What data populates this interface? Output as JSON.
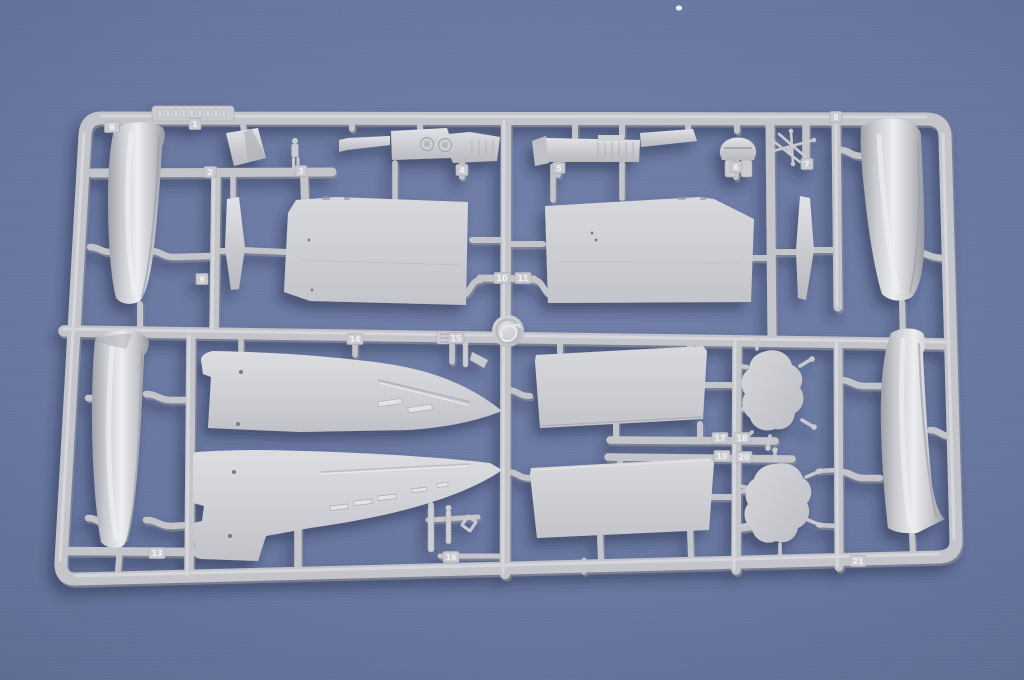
{
  "scene": {
    "subject": "Light grey injection-moulded plastic model kit sprue (runner B) with aircraft parts, photographed on a blue background",
    "background_colors": {
      "center": "#6d7ca7",
      "mid": "#5f6e99",
      "corner": "#3a4469"
    },
    "plastic_colors": {
      "base": "#c6c7cc",
      "highlight": "#edeef1",
      "shadow": "#96989f"
    },
    "cast_shadow_color": "#1c2747"
  },
  "sprue": {
    "runner_letter": "B",
    "part_tags": [
      {
        "label": "B",
        "x": 112,
        "y": 127,
        "w": 15
      },
      {
        "label": "1",
        "x": 195,
        "y": 124,
        "w": 12
      },
      {
        "label": "2",
        "x": 210,
        "y": 172,
        "w": 12
      },
      {
        "label": "3",
        "x": 301,
        "y": 171,
        "w": 12
      },
      {
        "label": "4",
        "x": 462,
        "y": 170,
        "w": 12
      },
      {
        "label": "5",
        "x": 559,
        "y": 168,
        "w": 12
      },
      {
        "label": "6",
        "x": 736,
        "y": 167,
        "w": 12
      },
      {
        "label": "7",
        "x": 807,
        "y": 164,
        "w": 12
      },
      {
        "label": "8",
        "x": 836,
        "y": 117,
        "w": 12
      },
      {
        "label": "9",
        "x": 202,
        "y": 279,
        "w": 12
      },
      {
        "label": "10",
        "x": 502,
        "y": 278,
        "w": 16
      },
      {
        "label": "11",
        "x": 523,
        "y": 278,
        "w": 16
      },
      {
        "label": "13",
        "x": 157,
        "y": 553,
        "w": 16
      },
      {
        "label": "14",
        "x": 355,
        "y": 339,
        "w": 16
      },
      {
        "label": "15",
        "x": 456,
        "y": 338,
        "w": 16
      },
      {
        "label": "16",
        "x": 451,
        "y": 557,
        "w": 16
      },
      {
        "label": "17",
        "x": 720,
        "y": 438,
        "w": 16
      },
      {
        "label": "18",
        "x": 742,
        "y": 438,
        "w": 16
      },
      {
        "label": "19",
        "x": 722,
        "y": 456,
        "w": 16
      },
      {
        "label": "20",
        "x": 744,
        "y": 457,
        "w": 16
      },
      {
        "label": "21",
        "x": 858,
        "y": 561,
        "w": 16
      }
    ]
  }
}
